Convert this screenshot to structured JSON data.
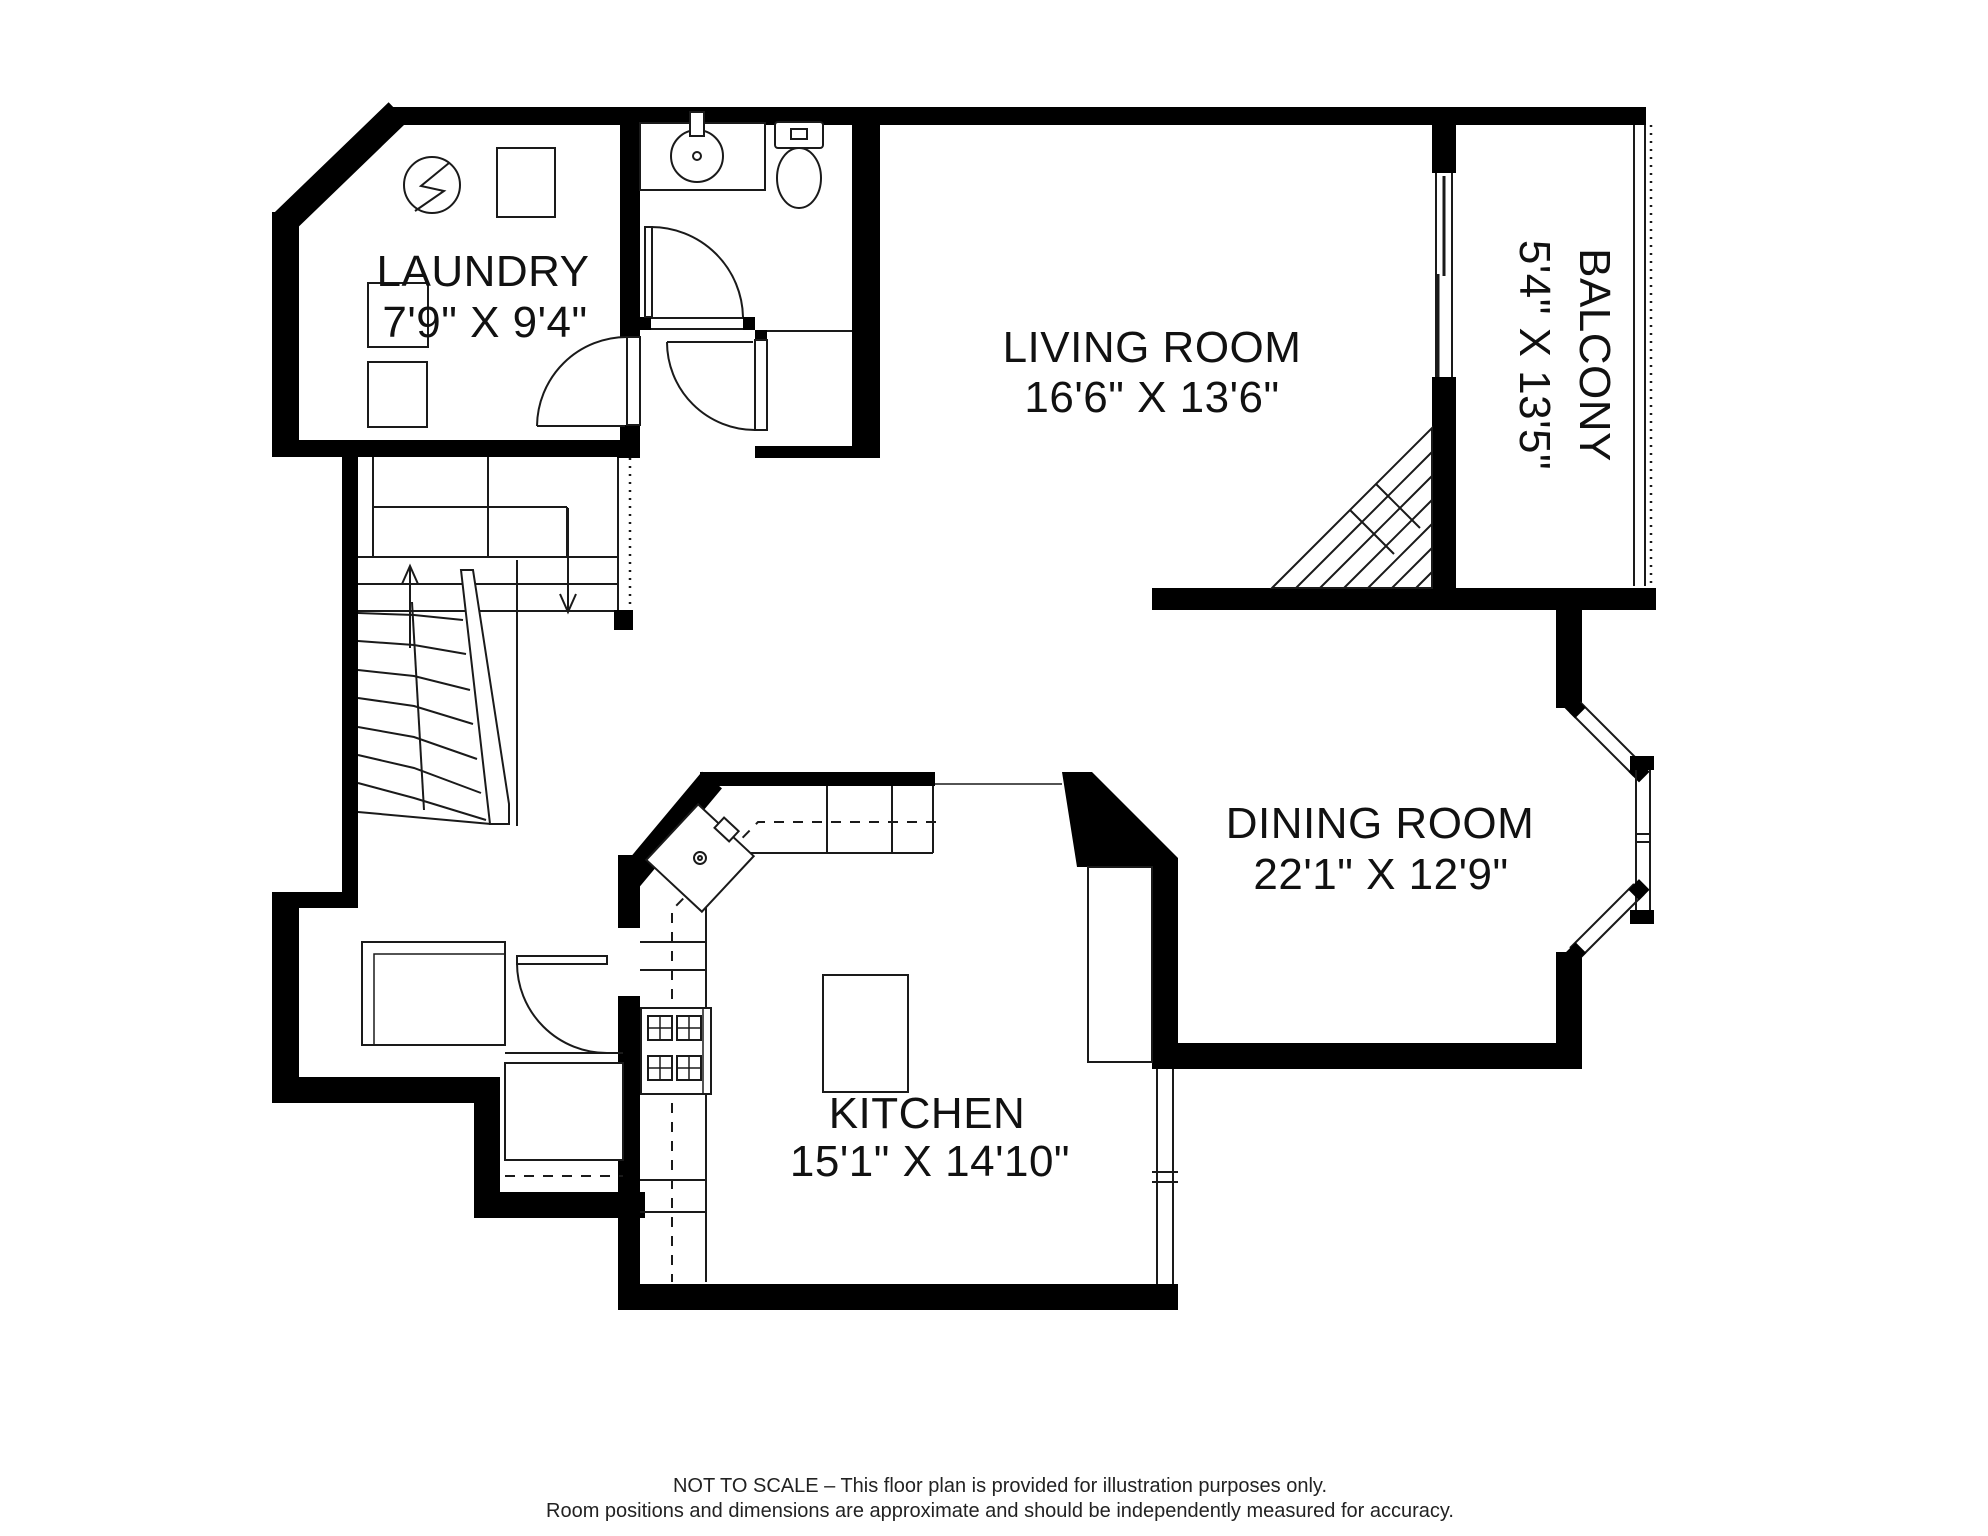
{
  "floor_plan": {
    "rooms": [
      {
        "id": "laundry",
        "name": "LAUNDRY",
        "dims": "7'9\" X 9'4\""
      },
      {
        "id": "living",
        "name": "LIVING ROOM",
        "dims": "16'6\" X 13'6\""
      },
      {
        "id": "balcony",
        "name": "BALCONY",
        "dims": "5'4\" X 13'5\""
      },
      {
        "id": "dining",
        "name": "DINING ROOM",
        "dims": "22'1\" X 12'9\""
      },
      {
        "id": "kitchen",
        "name": "KITCHEN",
        "dims": "15'1\" X 14'10\""
      }
    ],
    "disclaimer": {
      "line1": "NOT TO SCALE – This floor plan is provided for illustration purposes only.",
      "line2": "Room positions and dimensions are approximate and should be independently measured for accuracy."
    },
    "colors": {
      "wall": "#000000",
      "line": "#1a1a1a",
      "background": "#ffffff"
    },
    "icons": {
      "laundry_utility": "utility-circle-icon",
      "laundry_appliances": "washer-dryer-icon",
      "bath_sink": "sink-icon",
      "bath_toilet": "toilet-icon",
      "kitchen_corner_sink": "kitchen-sink-icon",
      "kitchen_range": "range-burners-icon",
      "kitchen_island": "island-icon",
      "stairs_up": "up-arrow-icon",
      "stairs_down": "down-arrow-icon"
    }
  }
}
